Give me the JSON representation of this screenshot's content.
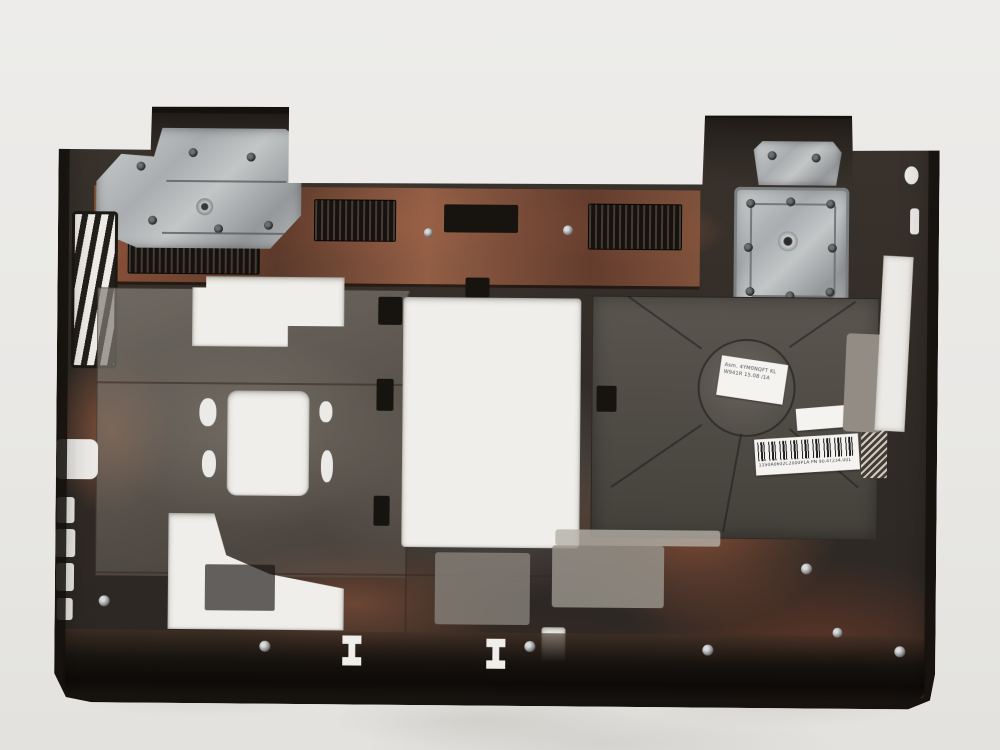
{
  "scene": {
    "type": "product-photo",
    "subject": "Laptop bottom base cover, interior view, on white foam background",
    "background_hex": "#e9e8e5",
    "plastic_hex": "#332d28",
    "copper_stain_hex": "#96654a",
    "metal_bracket_hex": "#b7babb",
    "cutout_hex": "#efeeea"
  },
  "stickers": {
    "part_label": {
      "line1": "Asm. 4YM0NQFT KL",
      "line2": "W941R 15.08 /1A"
    },
    "blank_label": {
      "text": ""
    },
    "barcode_label": {
      "code_text": "11S0A0602C2000P1A  PN  90.4T234.001"
    }
  }
}
